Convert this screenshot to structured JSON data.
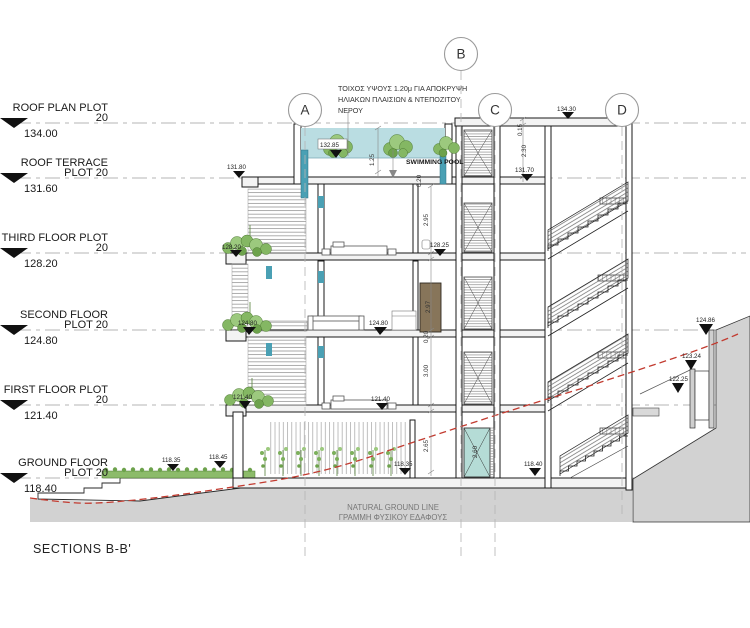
{
  "title": "SECTIONS B-B'",
  "levels": [
    {
      "line1": "ROOF PLAN PLOT",
      "line2": "20",
      "elev": "134.00"
    },
    {
      "line1": "ROOF TERRACE",
      "line2": "PLOT 20",
      "elev": "131.60"
    },
    {
      "line1": "THIRD FLOOR PLOT",
      "line2": "20",
      "elev": "128.20"
    },
    {
      "line1": "SECOND FLOOR",
      "line2": "PLOT 20",
      "elev": "124.80"
    },
    {
      "line1": "FIRST FLOOR PLOT",
      "line2": "20",
      "elev": "121.40"
    },
    {
      "line1": "GROUND FLOOR",
      "line2": "PLOT 20",
      "elev": "118.40"
    }
  ],
  "grid": [
    {
      "label": "A"
    },
    {
      "label": "B"
    },
    {
      "label": "C"
    },
    {
      "label": "D"
    }
  ],
  "notes": {
    "wall_note1": "ΤΟΙΧΟΣ ΥΨΟΥΣ 1.20μ ΓΙΑ ΑΠΟΚΡΥΨΗ",
    "wall_note2": "ΗΛΙΑΚΩΝ ΠΛΑΙΣΙΩΝ & ΝΤΕΠΟΖΙΤΟΥ",
    "wall_note3": "ΝΕΡΟΥ",
    "pool": "SWIMMING POOL",
    "ground_en": "NATURAL GROUND LINE",
    "ground_gr": "ΓΡΑΜΜΗ ΦΥΣΙΚΟΥ ΕΔΑΦΟΥΣ"
  },
  "spots": [
    {
      "v": "132.85"
    },
    {
      "v": "131.80"
    },
    {
      "v": "131.70"
    },
    {
      "v": "134.30"
    },
    {
      "v": "128.20"
    },
    {
      "v": "128.25"
    },
    {
      "v": "124.80"
    },
    {
      "v": "124.80"
    },
    {
      "v": "121.40"
    },
    {
      "v": "121.40"
    },
    {
      "v": "118.35"
    },
    {
      "v": "118.45"
    },
    {
      "v": "118.35"
    },
    {
      "v": "118.40"
    },
    {
      "v": "124.86"
    },
    {
      "v": "123.24"
    },
    {
      "v": "122.25"
    }
  ],
  "dims": [
    {
      "v": "1.25"
    },
    {
      "v": "0.20"
    },
    {
      "v": "2.95"
    },
    {
      "v": "2.97"
    },
    {
      "v": "0.20"
    },
    {
      "v": "3.00"
    },
    {
      "v": "2.65"
    },
    {
      "v": "0.15"
    },
    {
      "v": "2.30"
    },
    {
      "v": "2.60"
    }
  ],
  "colors": {
    "pool_water": "#badde2",
    "teal_accent": "#4aa0b4",
    "elevator_door_ground": "#b5dcd6",
    "vegetation": "#7cb05b",
    "ground_fill": "#d2d2d2",
    "natural_ground_line": "#c23b30",
    "wardrobe": "#87755a",
    "pool_label_color": "#3a3aad"
  }
}
